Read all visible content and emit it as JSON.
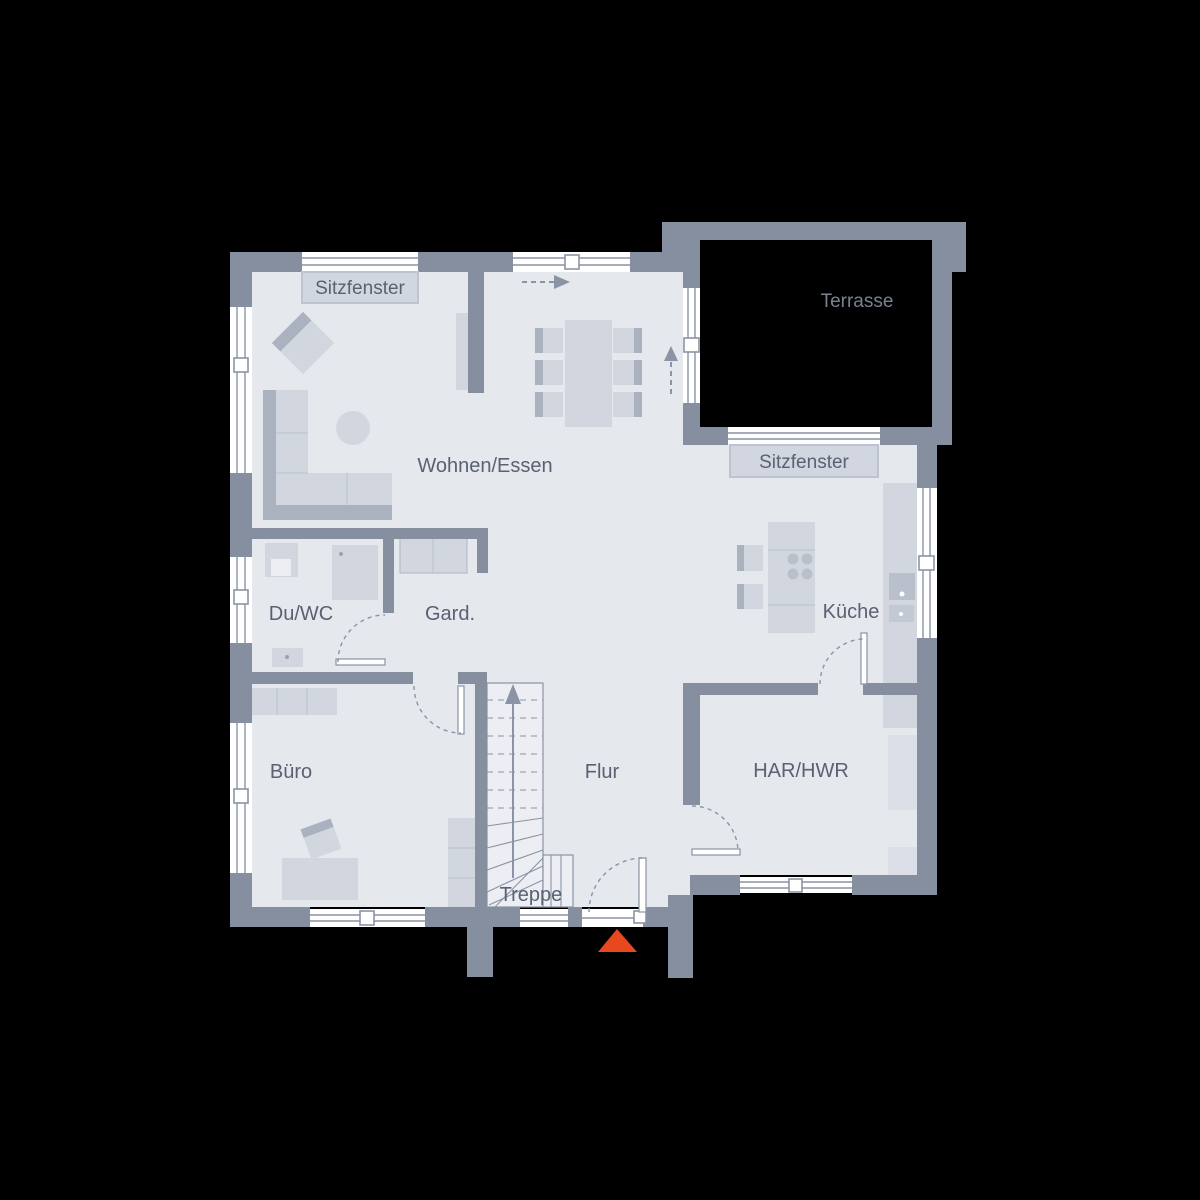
{
  "rooms": {
    "wohnen_essen": "Wohnen/Essen",
    "du_wc": "Du/WC",
    "gard": "Gard.",
    "kueche": "Küche",
    "buero": "Büro",
    "flur": "Flur",
    "har_hwr": "HAR/HWR",
    "treppe": "Treppe",
    "terrasse": "Terrasse"
  },
  "windows": {
    "sitzfenster_living": "Sitzfenster",
    "sitzfenster_kueche": "Sitzfenster"
  },
  "colors": {
    "background": "#000000",
    "wall": "#858fa0",
    "floor": "#e5e8ed",
    "furniture_light": "#d2d6df",
    "furniture_dark": "#aab1bf",
    "label_text": "#596172",
    "terrace_label_text": "#79818f",
    "label_box": "#d2d6e0",
    "entrance_marker": "#e8481e"
  }
}
